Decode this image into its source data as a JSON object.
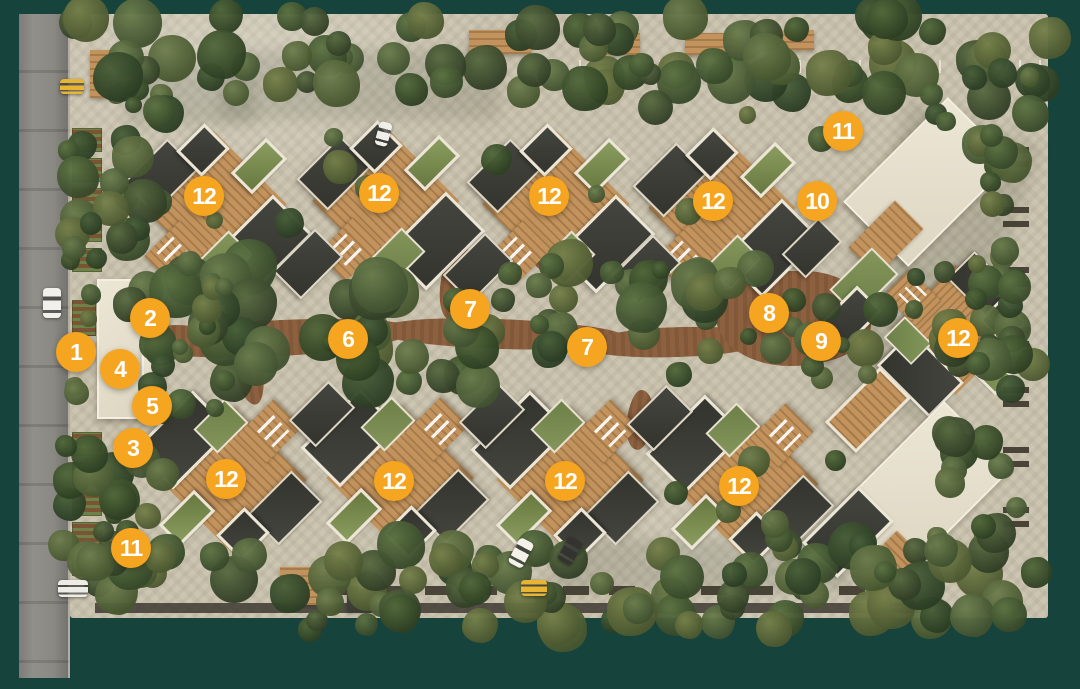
{
  "colors": {
    "background_teal": "#17433d",
    "marker_fill": "#F6A520",
    "marker_text": "#FFFFFF"
  },
  "markers": [
    {
      "label": "1",
      "x": 76,
      "y": 352
    },
    {
      "label": "2",
      "x": 150,
      "y": 318
    },
    {
      "label": "3",
      "x": 133,
      "y": 448
    },
    {
      "label": "4",
      "x": 120,
      "y": 369
    },
    {
      "label": "5",
      "x": 152,
      "y": 406
    },
    {
      "label": "6",
      "x": 348,
      "y": 339
    },
    {
      "label": "7",
      "x": 470,
      "y": 309
    },
    {
      "label": "7",
      "x": 587,
      "y": 347
    },
    {
      "label": "8",
      "x": 769,
      "y": 313
    },
    {
      "label": "9",
      "x": 821,
      "y": 341
    },
    {
      "label": "10",
      "x": 817,
      "y": 201
    },
    {
      "label": "11",
      "x": 843,
      "y": 131
    },
    {
      "label": "11",
      "x": 131,
      "y": 548
    },
    {
      "label": "12",
      "x": 204,
      "y": 196
    },
    {
      "label": "12",
      "x": 379,
      "y": 193
    },
    {
      "label": "12",
      "x": 549,
      "y": 196
    },
    {
      "label": "12",
      "x": 713,
      "y": 201
    },
    {
      "label": "12",
      "x": 958,
      "y": 338
    },
    {
      "label": "12",
      "x": 226,
      "y": 479
    },
    {
      "label": "12",
      "x": 394,
      "y": 481
    },
    {
      "label": "12",
      "x": 565,
      "y": 481
    },
    {
      "label": "12",
      "x": 739,
      "y": 486
    }
  ]
}
